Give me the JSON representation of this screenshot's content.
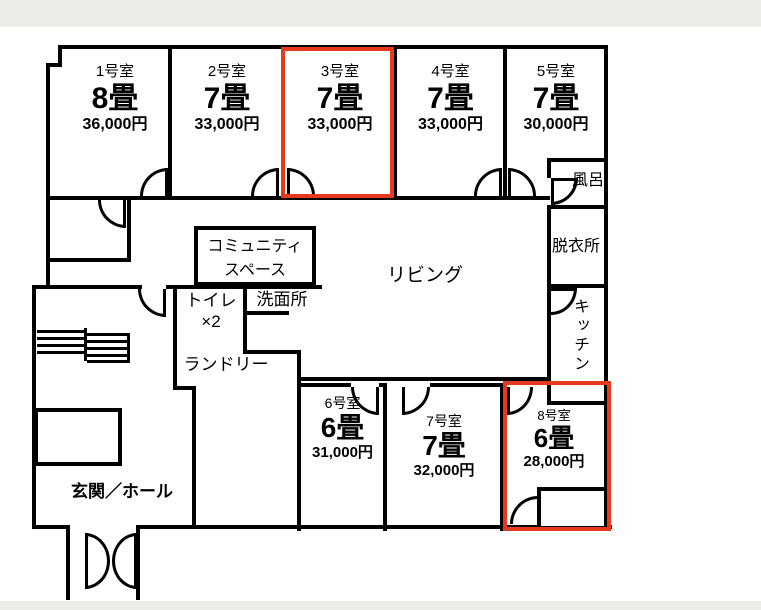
{
  "rooms": [
    {
      "name": "1号室",
      "size": "8畳",
      "price": "36,000円",
      "highlighted": false
    },
    {
      "name": "2号室",
      "size": "7畳",
      "price": "33,000円",
      "highlighted": false
    },
    {
      "name": "3号室",
      "size": "7畳",
      "price": "33,000円",
      "highlighted": true
    },
    {
      "name": "4号室",
      "size": "7畳",
      "price": "33,000円",
      "highlighted": false
    },
    {
      "name": "5号室",
      "size": "7畳",
      "price": "30,000円",
      "highlighted": false
    },
    {
      "name": "6号室",
      "size": "6畳",
      "price": "31,000円",
      "highlighted": false
    },
    {
      "name": "7号室",
      "size": "7畳",
      "price": "32,000円",
      "highlighted": false
    },
    {
      "name": "8号室",
      "size": "6畳",
      "price": "28,000円",
      "highlighted": true
    }
  ],
  "facilities": {
    "living": "リビング",
    "bath": "風呂",
    "dressing_room": "脱衣所",
    "kitchen": "キッチン",
    "community_line1": "コミュニティ",
    "community_line2": "スペース",
    "washroom": "洗面所",
    "toilet_line1": "トイレ",
    "toilet_line2": "×2",
    "laundry": "ランドリー",
    "entrance": "玄関／ホール"
  },
  "colors": {
    "highlight": "#E63A1F",
    "wall": "#000000",
    "margin_strip": "#EDECE7"
  }
}
